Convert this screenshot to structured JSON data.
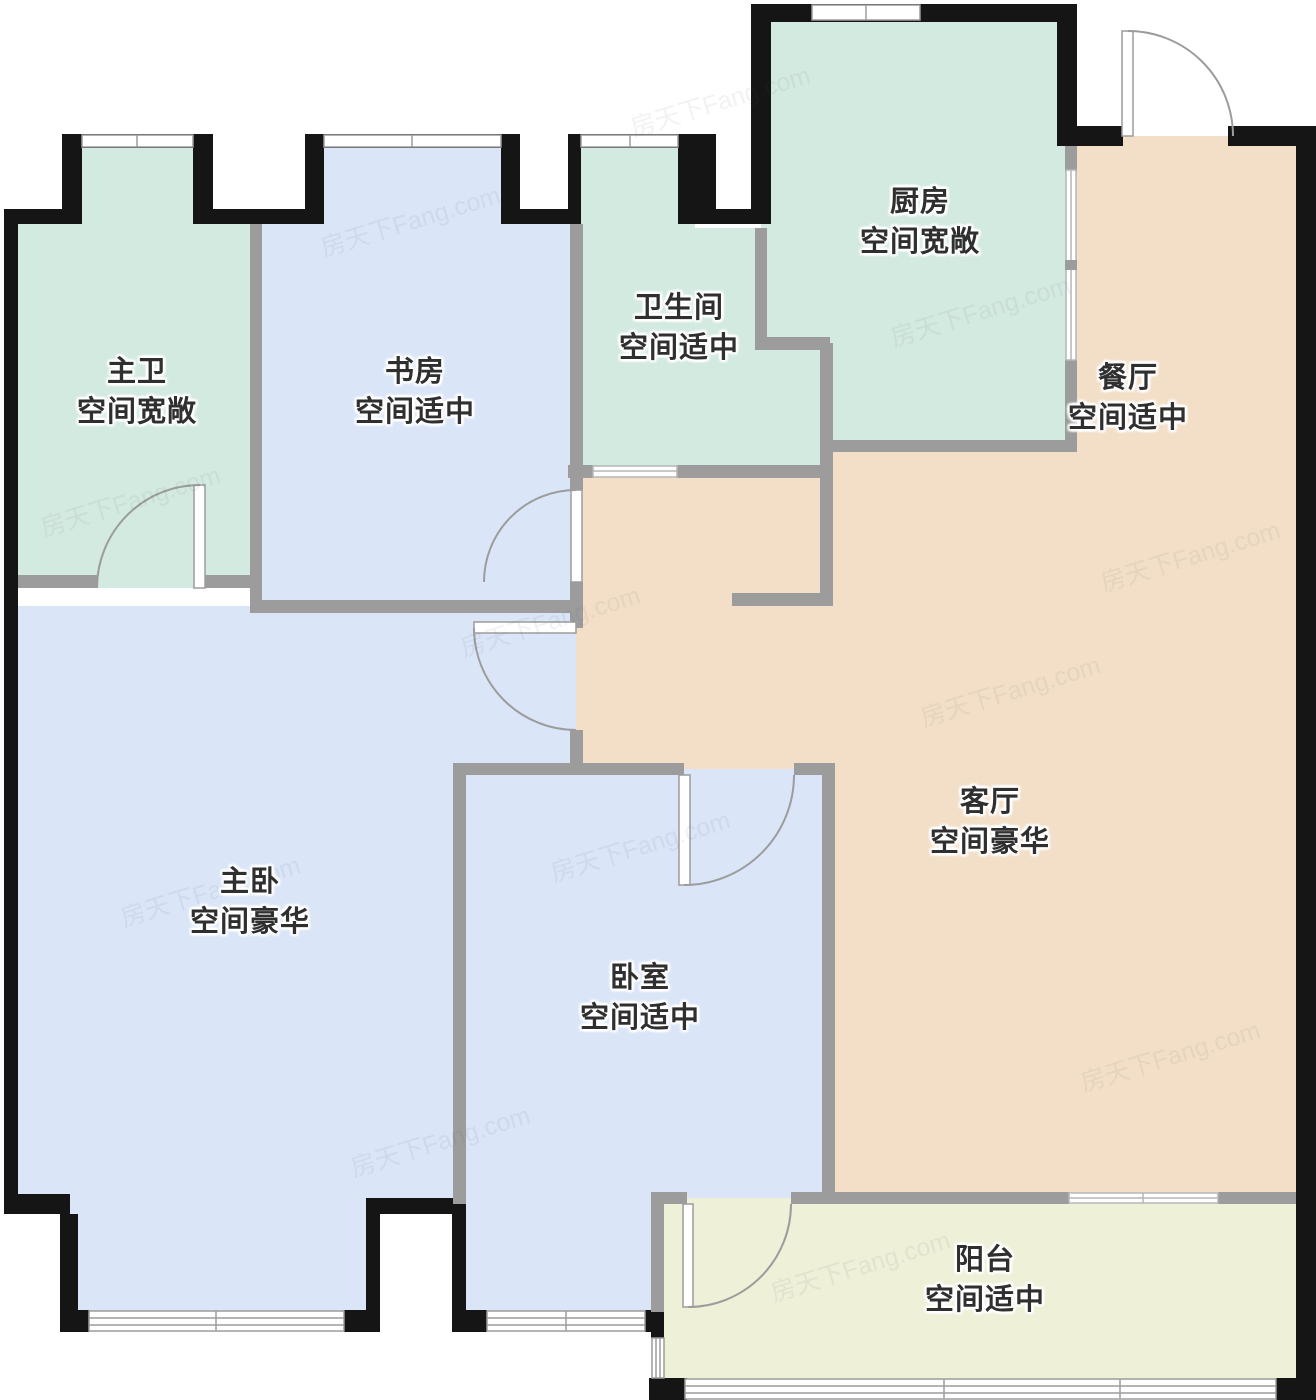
{
  "watermark": {
    "text": "房天下Fang.com"
  },
  "colors": {
    "wall_outer": "#151515",
    "wall_inner": "#9c9c9c",
    "room_green": "#d3eae0",
    "room_blue": "#dae6f8",
    "room_peach": "#f3dfc8",
    "room_balcony": "#eef0d7",
    "label_text": "#2f2f2f",
    "window_line": "#9c9c9c"
  },
  "rooms": [
    {
      "id": "master-bath",
      "name": "主卫",
      "desc": "空间宽敞"
    },
    {
      "id": "study",
      "name": "书房",
      "desc": "空间适中"
    },
    {
      "id": "bathroom",
      "name": "卫生间",
      "desc": "空间适中"
    },
    {
      "id": "kitchen",
      "name": "厨房",
      "desc": "空间宽敞"
    },
    {
      "id": "dining",
      "name": "餐厅",
      "desc": "空间适中"
    },
    {
      "id": "master-bedroom",
      "name": "主卧",
      "desc": "空间豪华"
    },
    {
      "id": "bedroom",
      "name": "卧室",
      "desc": "空间适中"
    },
    {
      "id": "living",
      "name": "客厅",
      "desc": "空间豪华"
    },
    {
      "id": "balcony",
      "name": "阳台",
      "desc": "空间适中"
    }
  ]
}
